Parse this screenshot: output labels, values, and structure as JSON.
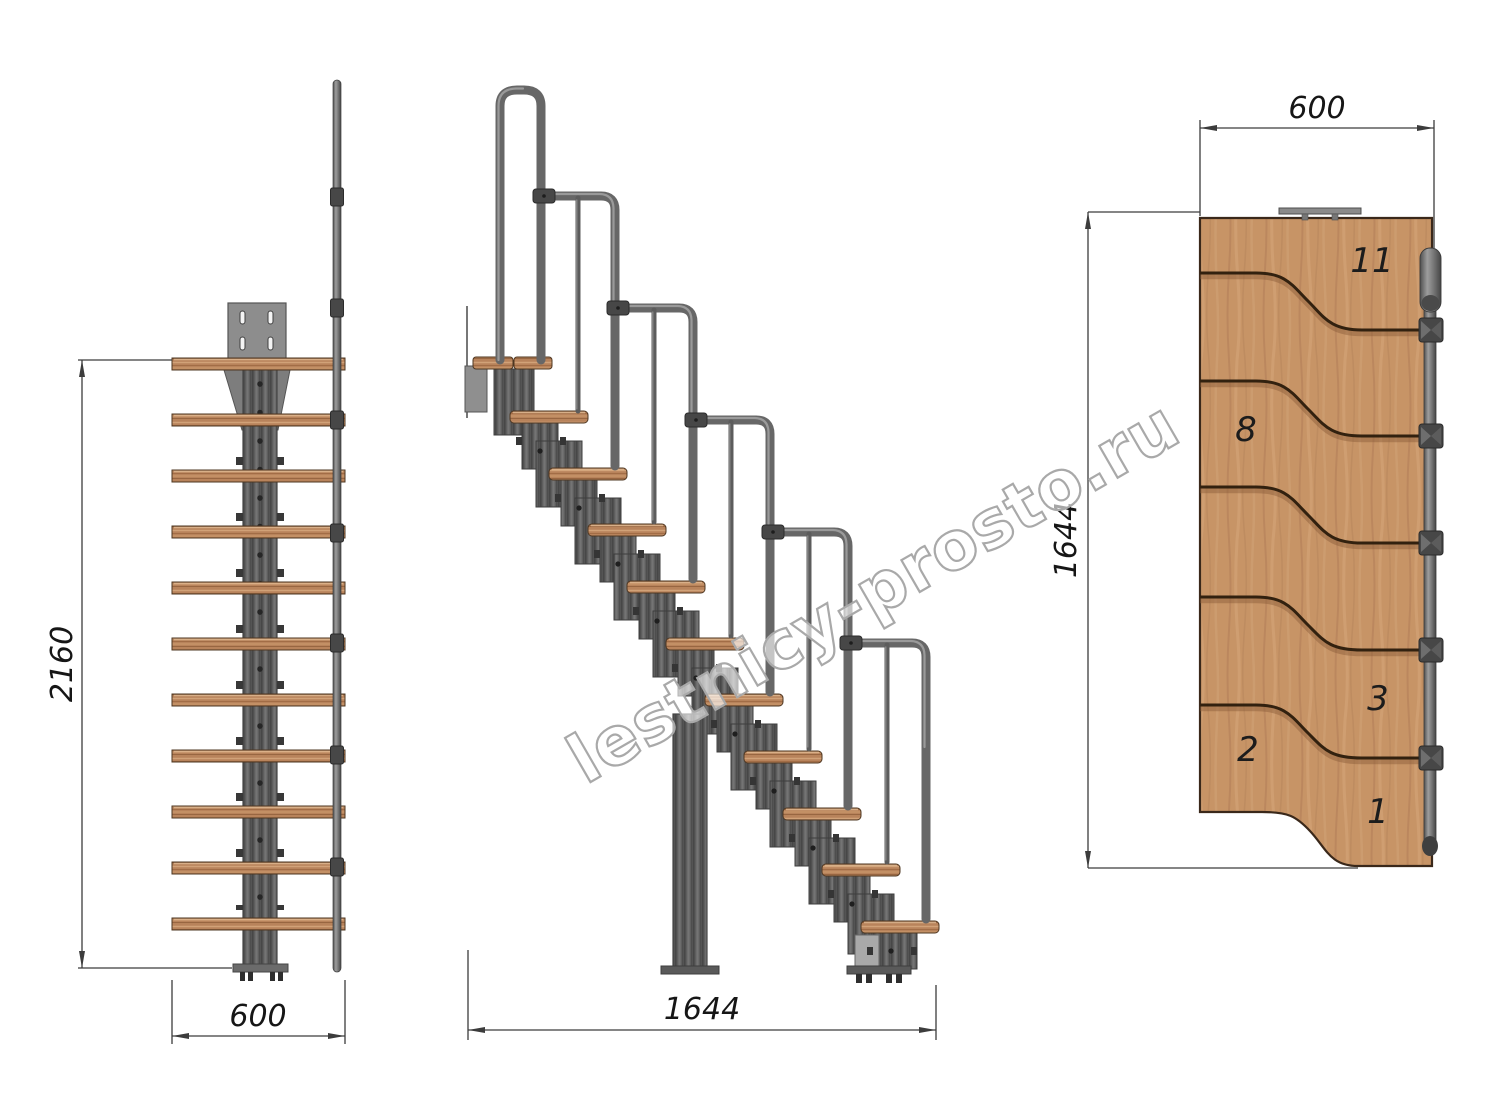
{
  "watermark": {
    "text": "lestnicy-prosto.ru"
  },
  "front_view": {
    "height_dim": "2160",
    "width_dim": "600"
  },
  "side_view": {
    "length_dim": "1644"
  },
  "plan_view": {
    "width_dim": "600",
    "length_dim": "1644",
    "step_numbers": [
      "11",
      "8",
      "3",
      "2",
      "1"
    ]
  },
  "colors": {
    "wood": "#c79466",
    "metal": "#616161",
    "dim_line": "#3c3c3c",
    "watermark_outline": "#a9a9a9"
  }
}
